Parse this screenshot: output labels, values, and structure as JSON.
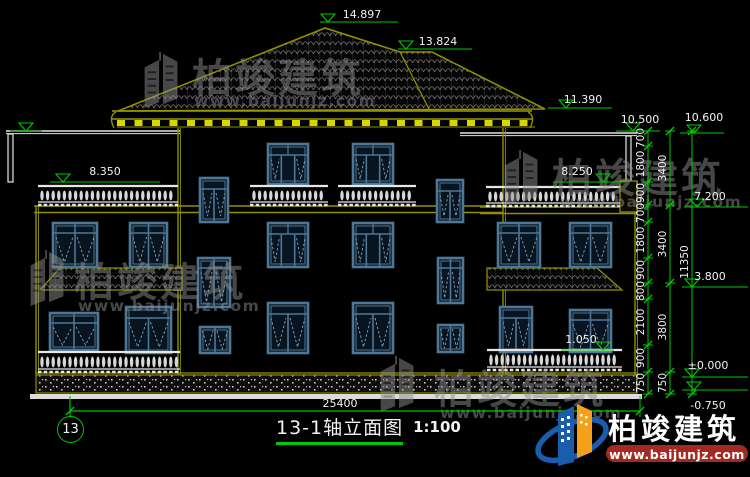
{
  "canvas": {
    "w": 750,
    "h": 477
  },
  "colors": {
    "bg": "#000000",
    "wall": "#8F8F00",
    "wallBright": "#D6D600",
    "win": "#4E7795",
    "winLight": "#7FA3BC",
    "winFill": "#081420",
    "white": "#E6E6E6",
    "green": "#00C800",
    "text": "#F2F2F2",
    "tile": "#707070",
    "speck": "#C9C9C9",
    "wm": "#8F8F8F",
    "logoBlue": "#1A5DAD",
    "logoOrange": "#F5A01B",
    "barRed": "#A32A22"
  },
  "title_block": {
    "title": "13-1轴立面图",
    "scale": "1:100"
  },
  "grid_bubble": {
    "label": "13"
  },
  "branding": {
    "name": "柏竣建筑",
    "url": "www.baijunjz.com"
  },
  "dims": {
    "bottom": {
      "value": "25400",
      "y": 411,
      "x1": 70,
      "x2": 640,
      "label_x": 340,
      "label_y": 407
    },
    "chains": [
      {
        "x": 648,
        "ticks": [
          131,
          146,
          182,
          205,
          222,
          258,
          283,
          299,
          345,
          372,
          394
        ],
        "labels": [
          {
            "v": "700",
            "y": 138
          },
          {
            "v": "1800",
            "y": 164
          },
          {
            "v": "900",
            "y": 193
          },
          {
            "v": "700",
            "y": 213
          },
          {
            "v": "1800",
            "y": 240
          },
          {
            "v": "900",
            "y": 270
          },
          {
            "v": "800",
            "y": 291
          },
          {
            "v": "2100",
            "y": 322
          },
          {
            "v": "900",
            "y": 358
          },
          {
            "v": "750",
            "y": 383
          }
        ]
      },
      {
        "x": 670,
        "ticks": [
          131,
          205,
          283,
          372,
          394
        ],
        "labels": [
          {
            "v": "3400",
            "y": 168
          },
          {
            "v": "3400",
            "y": 244
          },
          {
            "v": "3800",
            "y": 327
          },
          {
            "v": "750",
            "y": 383
          }
        ]
      },
      {
        "x": 692,
        "ticks": [
          131,
          394
        ],
        "labels": [
          {
            "v": "11350",
            "y": 262
          }
        ]
      }
    ],
    "elevations": [
      {
        "v": "14.897",
        "x1": 320,
        "x2": 398,
        "ly": 22,
        "tx": 362,
        "ty": 18,
        "ax": 328
      },
      {
        "v": "13.824",
        "x1": 398,
        "x2": 472,
        "ly": 49,
        "tx": 438,
        "ty": 45,
        "ax": 406
      },
      {
        "v": "11.390",
        "x1": 548,
        "x2": 612,
        "ly": 108,
        "tx": 583,
        "ty": 103,
        "ax": 566
      },
      {
        "v": "10.500",
        "x1": 616,
        "x2": 660,
        "ly": 131,
        "tx": 640,
        "ty": 123,
        "ax": 633
      },
      {
        "v": "10.600",
        "x1": 680,
        "x2": 724,
        "ly": 133,
        "tx": 704,
        "ty": 121,
        "ax": 694
      },
      {
        "v": "8.350",
        "x1": 50,
        "x2": 160,
        "ly": 182,
        "tx": 105,
        "ty": 175,
        "ax": 63
      },
      {
        "v": "8.250",
        "x1": 553,
        "x2": 625,
        "ly": 182,
        "tx": 577,
        "ty": 175,
        "ax": 603
      },
      {
        "v": "7.200",
        "x1": 684,
        "x2": 748,
        "ly": 207,
        "tx": 710,
        "ty": 200,
        "ax": 697
      },
      {
        "v": "3.800",
        "x1": 682,
        "x2": 748,
        "ly": 287,
        "tx": 710,
        "ty": 280,
        "ax": 692
      },
      {
        "v": "±0.000",
        "x1": 682,
        "x2": 748,
        "ly": 377,
        "tx": 708,
        "ty": 369,
        "ax": 692
      },
      {
        "v": "-0.750",
        "x1": 682,
        "x2": 748,
        "ly": 390,
        "tx": 708,
        "ty": 409,
        "ax": 694,
        "below": true
      },
      {
        "v": "1.050",
        "x1": 561,
        "x2": 614,
        "ly": 350,
        "tx": 581,
        "ty": 343,
        "ax": 603
      },
      {
        "v": "",
        "x1": 10,
        "x2": 42,
        "ly": 131,
        "tx": 0,
        "ty": 0,
        "ax": 26
      }
    ]
  },
  "geometry": {
    "roof": {
      "main": [
        [
          118,
          111
        ],
        [
          325,
          28
        ],
        [
          400,
          52
        ],
        [
          432,
          52
        ],
        [
          545,
          109
        ]
      ],
      "inner": [
        [
          400,
          52
        ],
        [
          430,
          111
        ]
      ],
      "fascia": {
        "x1": 112,
        "x2": 532,
        "y1": 111,
        "y2": 119
      },
      "blocks": {
        "y": 120,
        "x1": 117,
        "x2": 527,
        "step": 17.5,
        "w": 8,
        "h": 6
      }
    },
    "terrace": {
      "lines": [
        [
          6,
          131,
          180
        ],
        [
          460,
          133,
          637
        ]
      ],
      "posts": [
        [
          8,
          134,
          48
        ],
        [
          626,
          136,
          48
        ]
      ]
    },
    "walls": [
      {
        "x": 36,
        "y1": 206,
        "y2": 375
      },
      {
        "x": 178,
        "y1": 128,
        "y2": 375
      },
      {
        "x": 503,
        "y1": 128,
        "y2": 375
      },
      {
        "x": 635,
        "y1": 181,
        "y2": 377
      }
    ],
    "bands": [
      {
        "x1": 34,
        "x2": 180,
        "y": 206
      },
      {
        "x1": 178,
        "x2": 503,
        "y": 206
      },
      {
        "x1": 480,
        "x2": 637,
        "y": 207
      }
    ],
    "lines": [
      {
        "x1": 36,
        "x2": 637,
        "y": 373
      }
    ],
    "corner": {
      "x": 620,
      "y": 181,
      "w": 17,
      "h": 31
    },
    "windows": [
      {
        "s": "door2",
        "x": 200,
        "y": 178,
        "w": 28,
        "h": 44
      },
      {
        "s": "fw",
        "x": 268,
        "y": 144,
        "w": 40,
        "h": 40
      },
      {
        "s": "fw",
        "x": 353,
        "y": 144,
        "w": 40,
        "h": 40
      },
      {
        "s": "door2",
        "x": 437,
        "y": 180,
        "w": 26,
        "h": 42
      },
      {
        "s": "w2t",
        "x": 53,
        "y": 223,
        "w": 44,
        "h": 44
      },
      {
        "s": "w2t",
        "x": 130,
        "y": 223,
        "w": 37,
        "h": 44
      },
      {
        "s": "fw",
        "x": 268,
        "y": 223,
        "w": 40,
        "h": 44
      },
      {
        "s": "fw",
        "x": 353,
        "y": 223,
        "w": 40,
        "h": 44
      },
      {
        "s": "w2t",
        "x": 498,
        "y": 223,
        "w": 42,
        "h": 44
      },
      {
        "s": "w2t",
        "x": 570,
        "y": 223,
        "w": 41,
        "h": 44
      },
      {
        "s": "w2t",
        "x": 198,
        "y": 258,
        "w": 32,
        "h": 49
      },
      {
        "s": "w2t",
        "x": 438,
        "y": 258,
        "w": 25,
        "h": 45
      },
      {
        "s": "w2t",
        "x": 50,
        "y": 313,
        "w": 48,
        "h": 37
      },
      {
        "s": "dd",
        "x": 126,
        "y": 307,
        "w": 45,
        "h": 46
      },
      {
        "s": "dd",
        "x": 268,
        "y": 303,
        "w": 40,
        "h": 50
      },
      {
        "s": "dd",
        "x": 353,
        "y": 303,
        "w": 40,
        "h": 50
      },
      {
        "s": "small2",
        "x": 200,
        "y": 327,
        "w": 30,
        "h": 26
      },
      {
        "s": "small2",
        "x": 438,
        "y": 325,
        "w": 25,
        "h": 27
      },
      {
        "s": "dd",
        "x": 500,
        "y": 307,
        "w": 32,
        "h": 45
      },
      {
        "s": "w2t",
        "x": 570,
        "y": 310,
        "w": 41,
        "h": 42
      }
    ],
    "balustrades": [
      [
        38,
        184,
        140,
        22
      ],
      [
        250,
        184,
        78,
        22
      ],
      [
        338,
        184,
        78,
        22
      ],
      [
        486,
        185,
        134,
        22
      ],
      [
        38,
        350,
        142,
        23
      ],
      [
        487,
        348,
        135,
        23
      ]
    ],
    "canopies": [
      [
        [
          60,
          268
        ],
        [
          182,
          268
        ],
        [
          182,
          290
        ],
        [
          40,
          290
        ]
      ],
      [
        [
          487,
          268
        ],
        [
          597,
          268
        ],
        [
          622,
          290
        ],
        [
          487,
          290
        ]
      ]
    ],
    "plinth": {
      "x": 36,
      "y": 375,
      "w": 601,
      "h": 18
    },
    "ground": {
      "x": 30,
      "y": 394,
      "w": 612,
      "h": 5
    },
    "bubble": {
      "cx": 70,
      "cy": 429,
      "r": 12.5,
      "line_y1": 396,
      "line_y2": 416
    }
  },
  "watermarks": [
    {
      "ix": 140,
      "iy": 52,
      "tx": 192,
      "ty": 92,
      "ux": 194,
      "uy": 106,
      "fs": 40
    },
    {
      "ix": 500,
      "iy": 150,
      "tx": 552,
      "ty": 192,
      "ux": 560,
      "uy": 207,
      "fs": 40
    },
    {
      "ix": 26,
      "iy": 250,
      "tx": 74,
      "ty": 296,
      "ux": 78,
      "uy": 311,
      "fs": 40
    },
    {
      "ix": 376,
      "iy": 356,
      "tx": 434,
      "ty": 403,
      "ux": 440,
      "uy": 418,
      "fs": 40
    }
  ]
}
